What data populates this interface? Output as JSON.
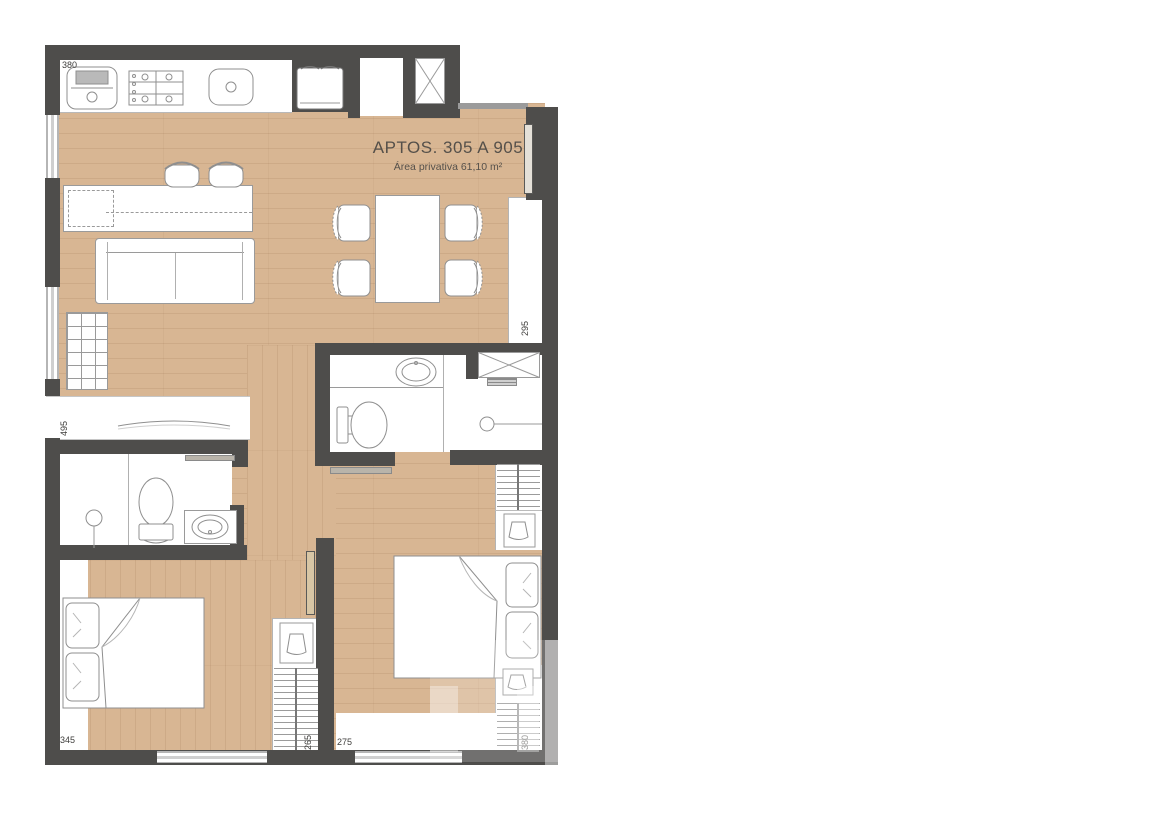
{
  "plan": {
    "title": "APTOS. 305 A 905",
    "subtitle": "Área privativa 61,10 m²",
    "dimensions": {
      "kitchen_top": "380",
      "living_right": "295",
      "living_left": "495",
      "bedroom1_bottom": "345",
      "bedroom1_closet": "265",
      "bedroom2_bottom": "275",
      "bedroom2_closet": "380"
    },
    "colors": {
      "wall": "#4e4d4b",
      "wood_floor": "#d8b693",
      "window_frame": "#b5b5b5",
      "fixture_outline": "#9a9a9a",
      "title_text": "#55504a",
      "dimension_text": "#3f3e3c"
    }
  }
}
